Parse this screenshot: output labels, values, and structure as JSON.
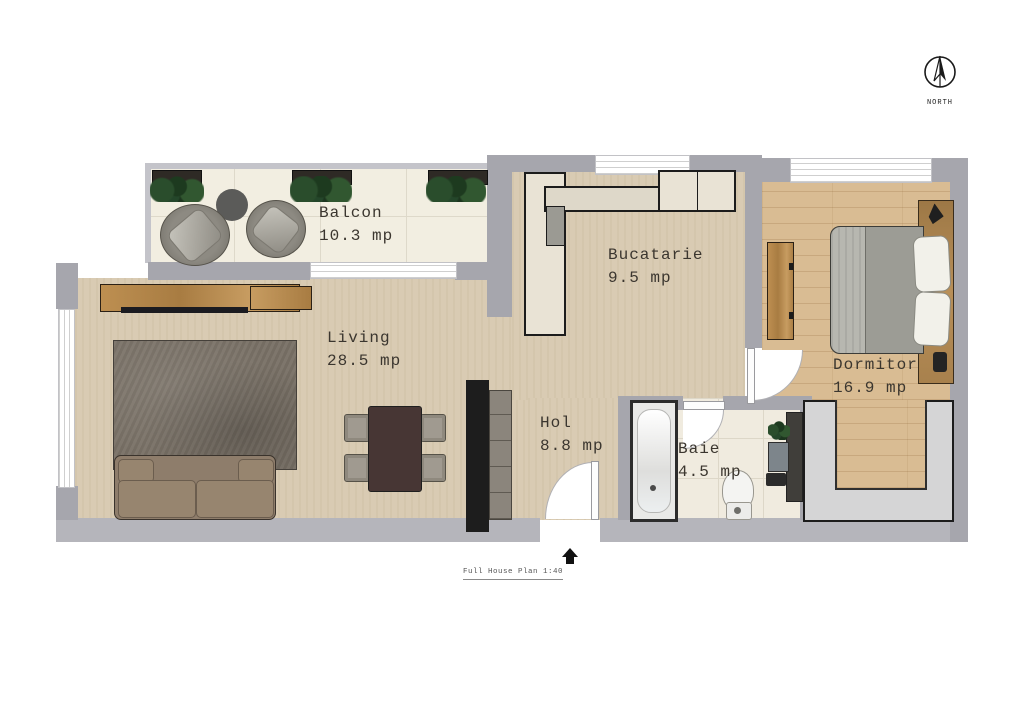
{
  "compass": {
    "label": "NORTH"
  },
  "rooms": [
    {
      "id": "balcon",
      "name": "Balcon",
      "area": "10.3 mp"
    },
    {
      "id": "bucatarie",
      "name": "Bucatarie",
      "area": "9.5 mp"
    },
    {
      "id": "living",
      "name": "Living",
      "area": "28.5 mp"
    },
    {
      "id": "hol",
      "name": "Hol",
      "area": "8.8 mp"
    },
    {
      "id": "baie",
      "name": "Baie",
      "area": "4.5 mp"
    },
    {
      "id": "dormitor",
      "name": "Dormitor",
      "area": "16.9 mp"
    }
  ],
  "title_block": {
    "title": "Full House Plan",
    "scale": "1:40"
  },
  "palette": {
    "wall": "#a6a6ad",
    "wall_light": "#b5b5bb",
    "floor_beige": "#d9cbb3",
    "floor_tile": "#f2eee1",
    "floor_wood": "#d9bc93",
    "counter_cream": "#e9e3d5",
    "rug_gray_brown": "#7a7267",
    "sofa_taupe": "#8e7d6b",
    "dining_table_brown": "#473634",
    "furniture_wood": "#b4884e",
    "plant_green": "#2a4d2c",
    "outline_dark": "#1c1c1c"
  }
}
